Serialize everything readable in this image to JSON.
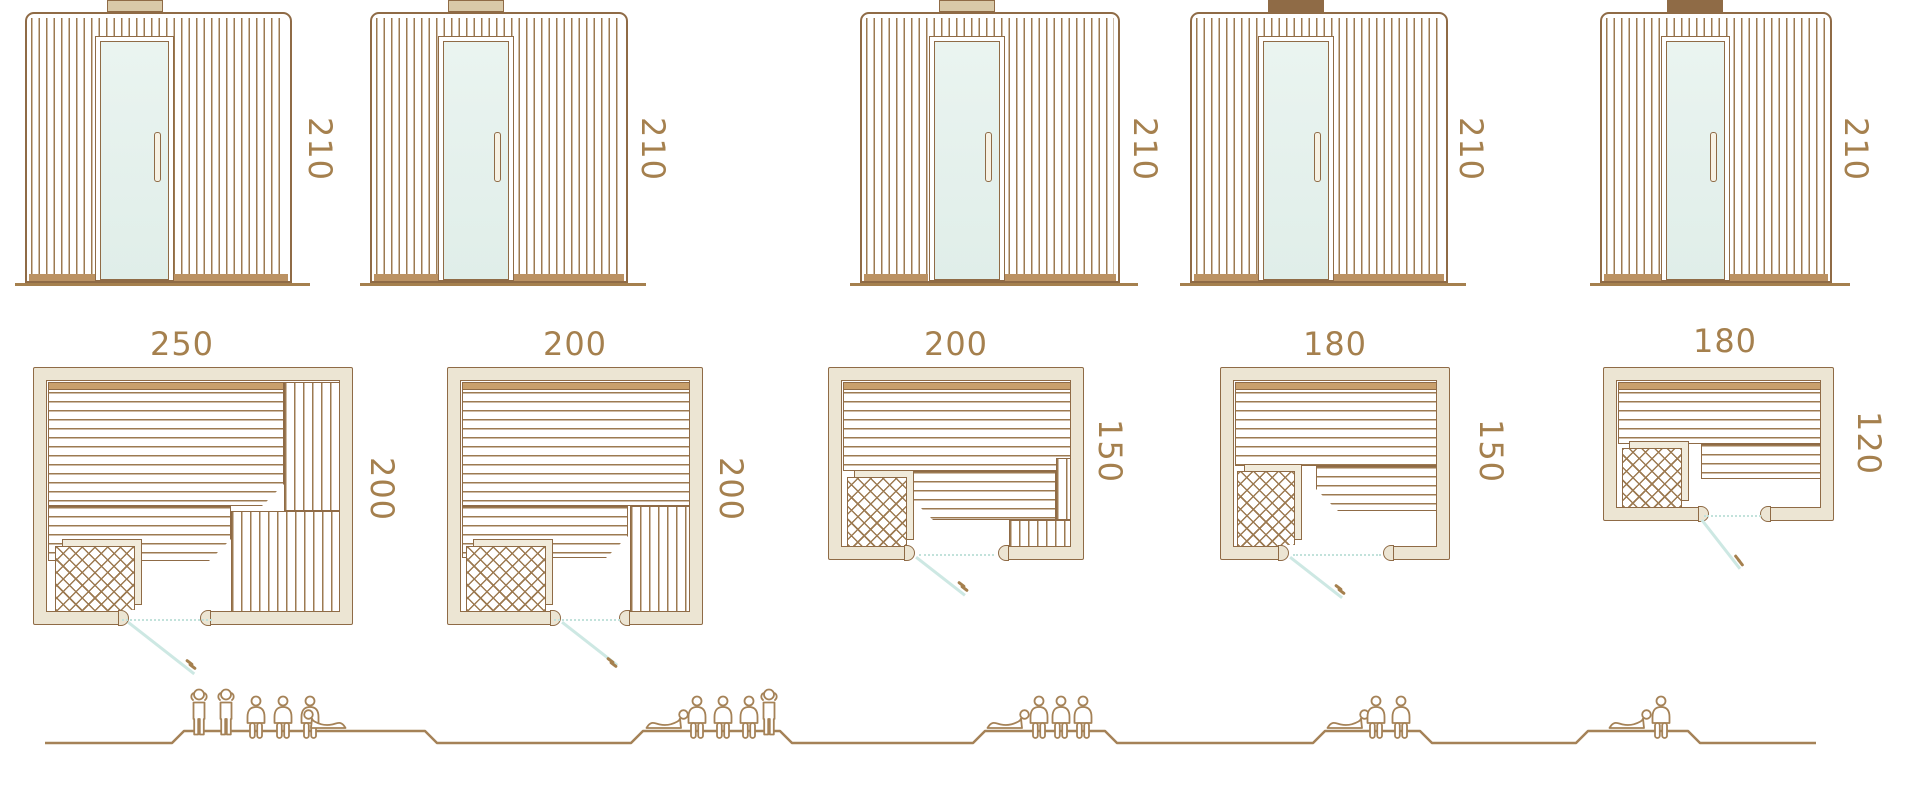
{
  "diagram_type": "sauna-size-comparison",
  "colors": {
    "line_brown": "#8f6b46",
    "slat_brown": "#9c7a51",
    "label_brown": "#a5804e",
    "wall_tan": "#ece5d3",
    "floor_tan": "#bb9263",
    "glass_mint": "#e4f1ed",
    "door_swing_teal": "#cde8e3",
    "people_brown": "#a58257"
  },
  "models": [
    {
      "id": "sauna-250x200",
      "front": {
        "height": "210"
      },
      "plan": {
        "width": "250",
        "depth": "200"
      },
      "capacity": {
        "standing": 2,
        "sitting": 3,
        "lying": 1,
        "total": 6
      }
    },
    {
      "id": "sauna-200x200",
      "front": {
        "height": "210"
      },
      "plan": {
        "width": "200",
        "depth": "200"
      },
      "capacity": {
        "standing": 1,
        "sitting": 3,
        "lying": 1,
        "total": 5
      }
    },
    {
      "id": "sauna-200x150",
      "front": {
        "height": "210"
      },
      "plan": {
        "width": "200",
        "depth": "150"
      },
      "capacity": {
        "standing": 0,
        "sitting": 3,
        "lying": 1,
        "total": 4
      }
    },
    {
      "id": "sauna-180x150",
      "front": {
        "height": "210"
      },
      "plan": {
        "width": "180",
        "depth": "150"
      },
      "capacity": {
        "standing": 0,
        "sitting": 2,
        "lying": 1,
        "total": 3
      }
    },
    {
      "id": "sauna-180x120",
      "front": {
        "height": "210"
      },
      "plan": {
        "width": "180",
        "depth": "120"
      },
      "capacity": {
        "standing": 0,
        "sitting": 1,
        "lying": 1,
        "total": 2
      }
    }
  ],
  "capacity_groups": [
    {
      "model": "sauna-250x200",
      "figures": [
        {
          "type": "standing",
          "x": 187
        },
        {
          "type": "standing",
          "x": 214
        },
        {
          "type": "sitting",
          "x": 243
        },
        {
          "type": "sitting",
          "x": 270
        },
        {
          "type": "sitting",
          "x": 297
        },
        {
          "type": "lying-head-left",
          "x": 303
        }
      ]
    },
    {
      "model": "sauna-200x200",
      "figures": [
        {
          "type": "lying-head-right",
          "x": 645
        },
        {
          "type": "sitting",
          "x": 684
        },
        {
          "type": "sitting",
          "x": 710
        },
        {
          "type": "sitting",
          "x": 736
        },
        {
          "type": "standing",
          "x": 757
        }
      ]
    },
    {
      "model": "sauna-200x150",
      "figures": [
        {
          "type": "lying-head-right",
          "x": 986
        },
        {
          "type": "sitting",
          "x": 1026
        },
        {
          "type": "sitting",
          "x": 1048
        },
        {
          "type": "sitting",
          "x": 1070
        }
      ]
    },
    {
      "model": "sauna-180x150",
      "figures": [
        {
          "type": "lying-head-right",
          "x": 1326
        },
        {
          "type": "sitting",
          "x": 1363
        },
        {
          "type": "sitting",
          "x": 1388
        }
      ]
    },
    {
      "model": "sauna-180x120",
      "figures": [
        {
          "type": "lying-head-right",
          "x": 1608
        },
        {
          "type": "sitting",
          "x": 1648
        }
      ]
    }
  ]
}
